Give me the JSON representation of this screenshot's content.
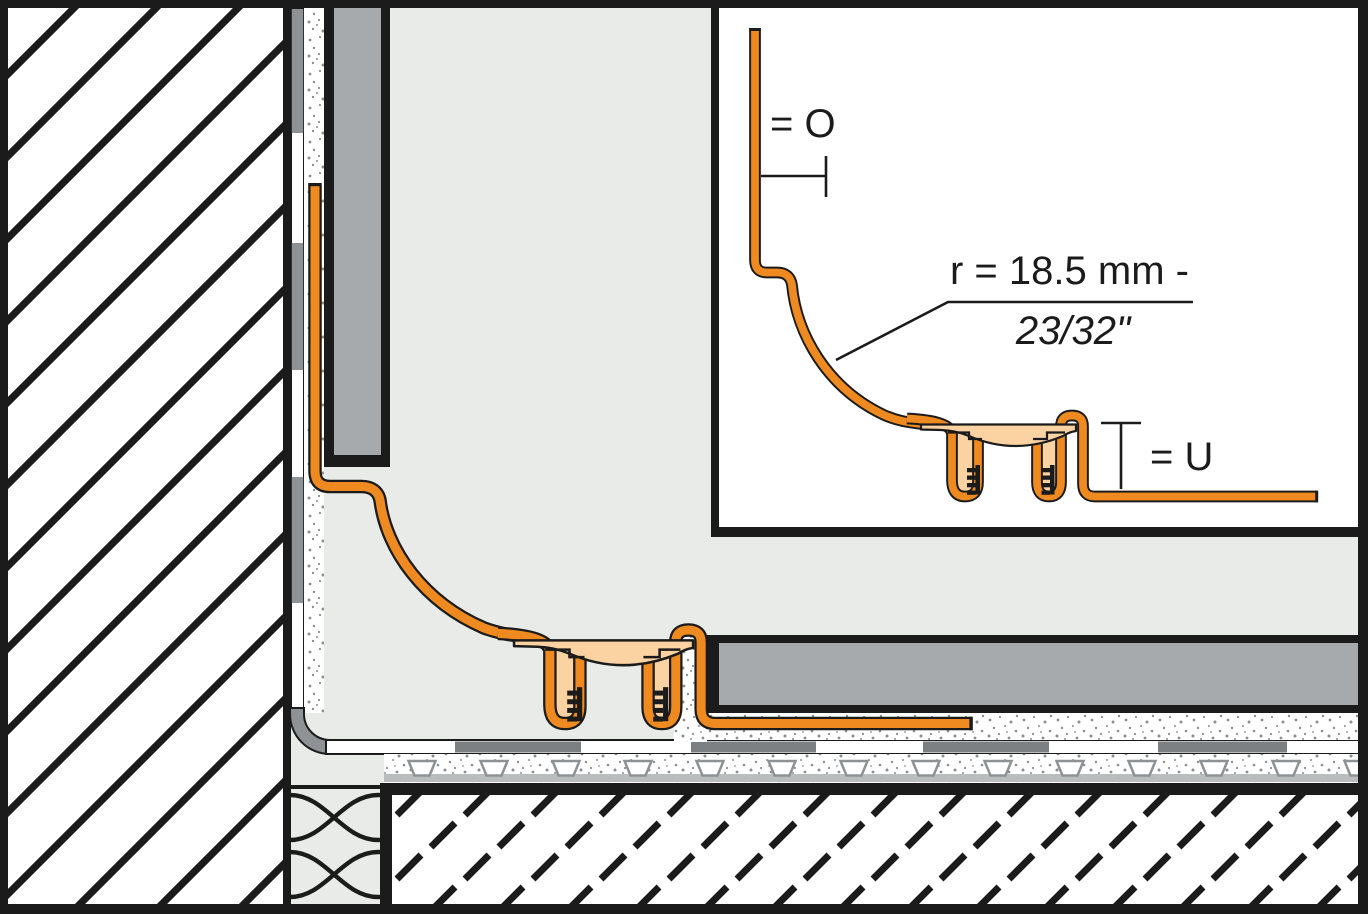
{
  "detail_inset": {
    "top_offset_label": "= O",
    "radius_label": "r = 18.5 mm -",
    "radius_imperial": "23/32\"",
    "bottom_offset_label": "= U"
  },
  "colors": {
    "profile_orange": "#EF8A21",
    "profile_peach": "#FBD2A2",
    "tile_gray": "#A7AAAC",
    "bonding_gray": "#8F9294",
    "mortar_segment_gray": "#7D8082",
    "membrane_band_gray": "#BABDBE",
    "room_gray": "#E9EBE8",
    "drawing_black": "#1B1B1B",
    "panel_white": "#FFFFFF"
  }
}
